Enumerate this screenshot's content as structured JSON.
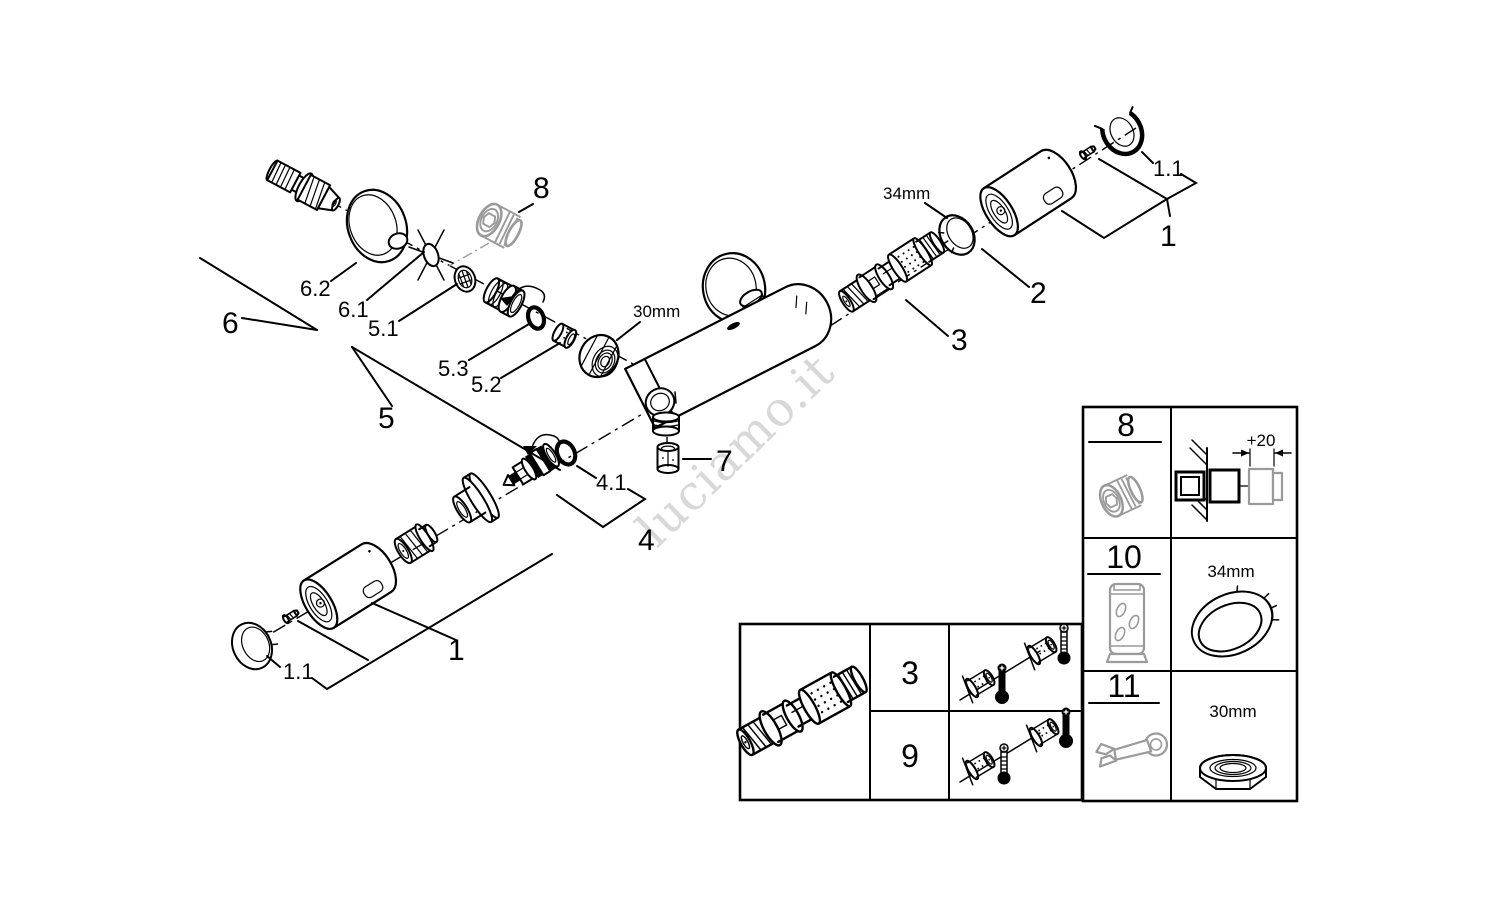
{
  "colors": {
    "line": "#000000",
    "gray_part": "#9a9a9a",
    "watermark": "#d8d8d8",
    "background": "#ffffff"
  },
  "watermark": {
    "text": "luciamo.it"
  },
  "exploded_view": {
    "groups": {
      "handle_top": {
        "number": "1",
        "cap": "1.1"
      },
      "handle_bottom": {
        "number": "1",
        "cap": "1.1"
      },
      "stop_ring": {
        "number": "2"
      },
      "thermostat_cartridge": {
        "number": "3"
      },
      "diverter": {
        "number": "4",
        "o_ring": "4.1"
      },
      "inlet_group": {
        "number": "5",
        "filter": "5.1",
        "bushing": "5.2",
        "o_ring": "5.3"
      },
      "s_union_group": {
        "number": "6",
        "seal": "6.1",
        "escutcheon": "6.2"
      },
      "check_valve": {
        "number": "7"
      },
      "extension": {
        "number": "8"
      }
    },
    "dimensions": {
      "union_nut": "30mm",
      "stop_ring": "34mm"
    }
  },
  "cartridge_table": {
    "part_icon": "thermostat-cartridge-icon",
    "rows": [
      {
        "number": "3",
        "left_thermo": "hot",
        "right_thermo": "cold"
      },
      {
        "number": "9",
        "left_thermo": "cold",
        "right_thermo": "hot"
      }
    ]
  },
  "tools_table": {
    "rows": [
      {
        "number": "8",
        "icon": "extension-fitting-icon",
        "detail": "+20"
      },
      {
        "number": "10",
        "icon": "socket-tool-icon",
        "detail": "34mm"
      },
      {
        "number": "11",
        "icon": "open-end-wrench-icon",
        "detail": "30mm"
      }
    ]
  }
}
